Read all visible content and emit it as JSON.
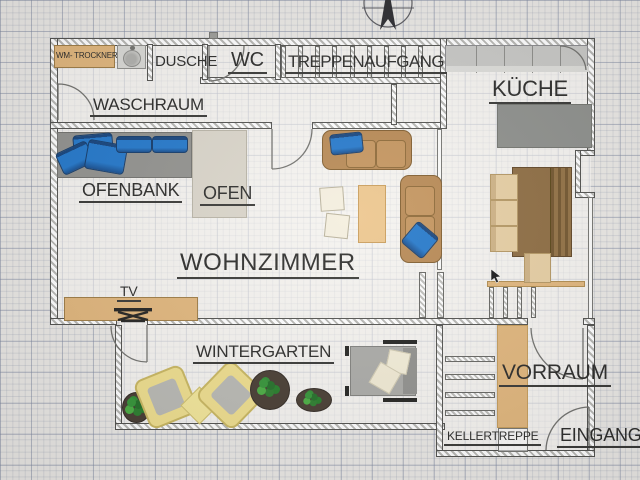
{
  "drawing": {
    "kind": "architectural floor plan, ground floor, graph-paper background",
    "compass": "north-arrow"
  },
  "labels": {
    "wm_trockner": "WM- TROCKNER",
    "dusche": "DUSCHE",
    "wc": "WC",
    "treppenaufgang": "TREPPENAUFGANG",
    "kueche": "KÜCHE",
    "waschraum": "WASCHRAUM",
    "ofenbank": "OFENBANK",
    "ofen": "OFEN",
    "wohnzimmer": "WOHNZIMMER",
    "tv": "TV",
    "wintergarten": "WINTERGARTEN",
    "vorraum": "VORRAUM",
    "kellertreppe": "KELLERTREPPE",
    "eingang": "EINGANG"
  },
  "colors": {
    "wood": "#e0b478",
    "bench": "#8f8f8b",
    "pillow": "#1d74c9",
    "sofa": "#b5854e",
    "counter": "#c6c6c3",
    "island": "#8a8c88",
    "table": "#8a683c",
    "chair": "#e6cda0",
    "oven": "#d9d4c8",
    "yellow": "#eedd8a",
    "green": "#2f8f2f",
    "ink": "#262624",
    "wallline": "#4d4d4a"
  }
}
